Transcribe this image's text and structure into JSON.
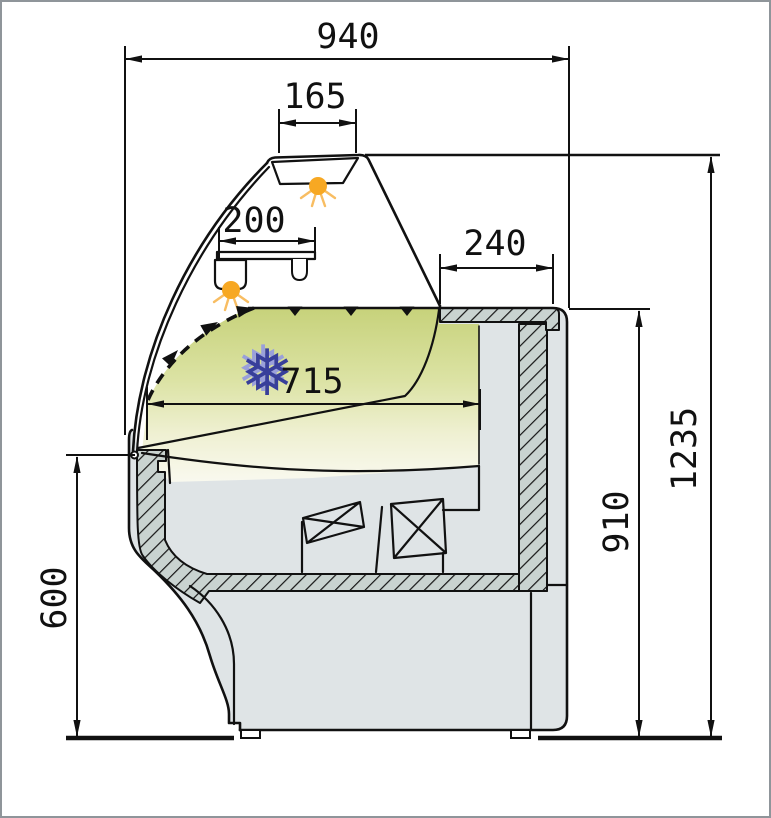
{
  "diagram": {
    "subject": "display-counter-cross-section",
    "dims": {
      "overall_depth": "940",
      "light_width": "165",
      "shelf_width": "200",
      "rear_top_depth": "240",
      "display_depth": "715",
      "overall_height": "1235",
      "rear_height": "910",
      "front_height": "600"
    },
    "icons": {
      "snowflake_glyph": "❅"
    },
    "colors": {
      "deck_green": "#c7d27b",
      "lamp_orange": "#f7a823",
      "snowflake_blue": "#383f9a",
      "hatch_fill": "#c9d3d0",
      "body_gray": "#dfe4e6",
      "line_black": "#111111"
    }
  }
}
